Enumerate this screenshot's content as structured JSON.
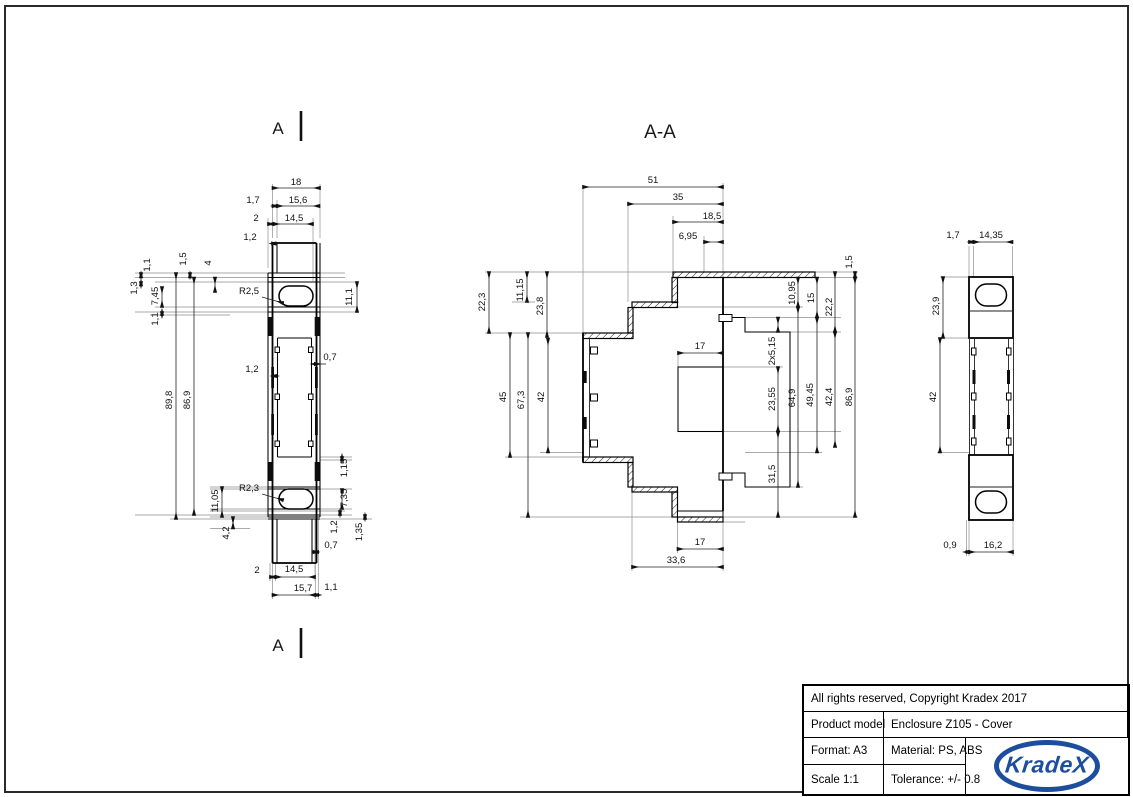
{
  "drawing": {
    "cut_label": "A",
    "section_title": "A-A",
    "views": {
      "front": {
        "dims": [
          [
            "18",
            296,
            185,
            0
          ],
          [
            "1,7",
            253,
            203,
            0
          ],
          [
            "15,6",
            298,
            203,
            0
          ],
          [
            "2",
            256,
            221,
            0
          ],
          [
            "14,5",
            294,
            221,
            0
          ],
          [
            "1,2",
            250,
            240,
            0
          ],
          [
            "1,1",
            150,
            265,
            1
          ],
          [
            "1,5",
            186,
            259,
            1
          ],
          [
            "4",
            211,
            263,
            1
          ],
          [
            "1,3",
            137,
            288,
            1
          ],
          [
            "7,45",
            158,
            296,
            1
          ],
          [
            "1,1",
            158,
            319,
            1
          ],
          [
            "R2,5",
            249,
            294,
            0
          ],
          [
            "11,1",
            352,
            297,
            1
          ],
          [
            "89,8",
            172,
            400,
            1
          ],
          [
            "86,9",
            190,
            400,
            1
          ],
          [
            "1,2",
            252,
            372,
            0
          ],
          [
            "0,7",
            330,
            360,
            0
          ],
          [
            "R2,3",
            249,
            491,
            0
          ],
          [
            "11,05",
            218,
            501,
            1
          ],
          [
            "1,15",
            347,
            468,
            1
          ],
          [
            "7,35",
            347,
            498,
            1
          ],
          [
            "1,2",
            337,
            527,
            1
          ],
          [
            "1,35",
            362,
            532,
            1
          ],
          [
            "4,2",
            229,
            533,
            1
          ],
          [
            "0,7",
            331,
            548,
            0
          ],
          [
            "2",
            257,
            573,
            0
          ],
          [
            "14,5",
            294,
            572,
            0
          ],
          [
            "15,7",
            303,
            591,
            0
          ],
          [
            "1,1",
            331,
            590,
            0
          ]
        ]
      },
      "section": {
        "dims": [
          [
            "51",
            653,
            183,
            0
          ],
          [
            "35",
            678,
            200,
            0
          ],
          [
            "18,5",
            712,
            219,
            0
          ],
          [
            "6,95",
            688,
            239,
            0
          ],
          [
            "1,5",
            852,
            262,
            1
          ],
          [
            "22,3",
            485,
            302,
            1
          ],
          [
            "11,15",
            523,
            290,
            1
          ],
          [
            "23,8",
            543,
            306,
            1
          ],
          [
            "45",
            506,
            397,
            1
          ],
          [
            "67,3",
            524,
            400,
            1
          ],
          [
            "42",
            544,
            397,
            1
          ],
          [
            "10,95",
            795,
            293,
            1
          ],
          [
            "15",
            814,
            298,
            1
          ],
          [
            "22,2",
            832,
            307,
            1
          ],
          [
            "2x5,15",
            775,
            351,
            1
          ],
          [
            "23,55",
            775,
            399,
            1
          ],
          [
            "64,9",
            795,
            398,
            1
          ],
          [
            "49,45",
            813,
            395,
            1
          ],
          [
            "42,4",
            832,
            397,
            1
          ],
          [
            "86,9",
            852,
            397,
            1
          ],
          [
            "31,5",
            775,
            474,
            1
          ],
          [
            "17",
            700,
            349,
            0
          ],
          [
            "17",
            700,
            545,
            0
          ],
          [
            "33,6",
            676,
            563,
            0
          ]
        ]
      },
      "side": {
        "dims": [
          [
            "1,7",
            953,
            238,
            0
          ],
          [
            "14,35",
            991,
            238,
            0
          ],
          [
            "23,9",
            939,
            306,
            1
          ],
          [
            "42",
            936,
            397,
            1
          ],
          [
            "0,9",
            950,
            548,
            0
          ],
          [
            "16,2",
            993,
            548,
            0
          ]
        ]
      }
    }
  },
  "title_block": {
    "copyright": "All rights reserved, Copyright Kradex 2017",
    "product_model_label": "Product model",
    "product_model_value": "Enclosure Z105 - Cover",
    "format": "Format: A3",
    "material": "Material: PS, ABS",
    "scale": "Scale 1:1",
    "tolerance": "Tolerance: +/- 0.8",
    "logo_text": "KradeX",
    "logo_color": "#1d4e9e"
  }
}
